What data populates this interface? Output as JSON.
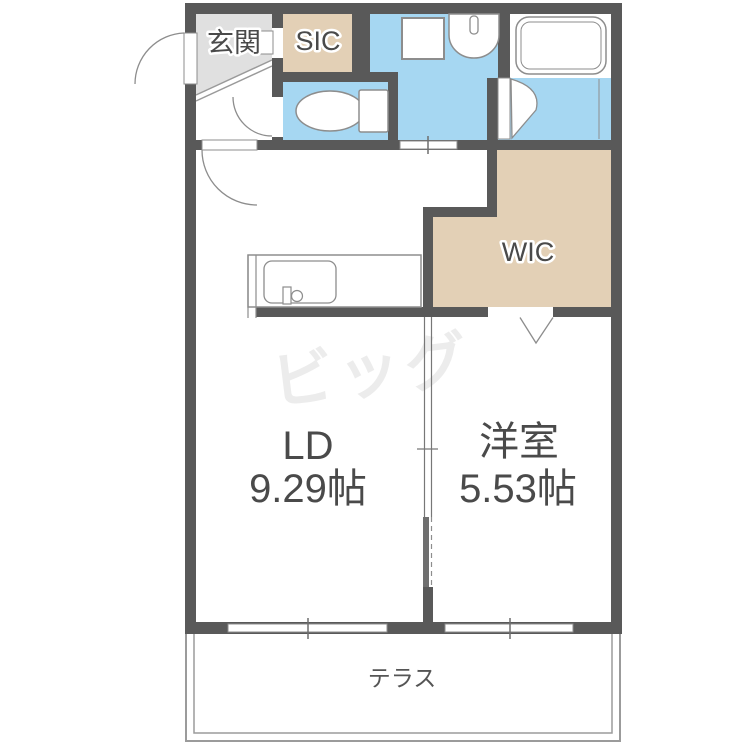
{
  "floorplan": {
    "rooms": {
      "genkan": {
        "label": "玄関"
      },
      "sic": {
        "label": "SIC"
      },
      "wic": {
        "label": "WIC"
      },
      "ld": {
        "label": "LD",
        "size": "9.29帖"
      },
      "western_room": {
        "label": "洋室",
        "size": "5.53帖"
      },
      "terrace": {
        "label": "テラス"
      }
    },
    "watermark": {
      "text": "ビッグ"
    },
    "colors": {
      "wall": "#595959",
      "water_area_floor": "#a6d7f2",
      "closet_floor": "#e3d0b6",
      "genkan_floor": "#e0e0e0",
      "fixture_outline": "#8d8d8d",
      "label_text": "#4a4a4a",
      "watermark": "#ececec",
      "terrace_line": "#9b9b9b"
    },
    "fixtures": [
      "bathtub",
      "washbasin",
      "washing-machine-pad",
      "toilet",
      "kitchen-sink"
    ]
  }
}
